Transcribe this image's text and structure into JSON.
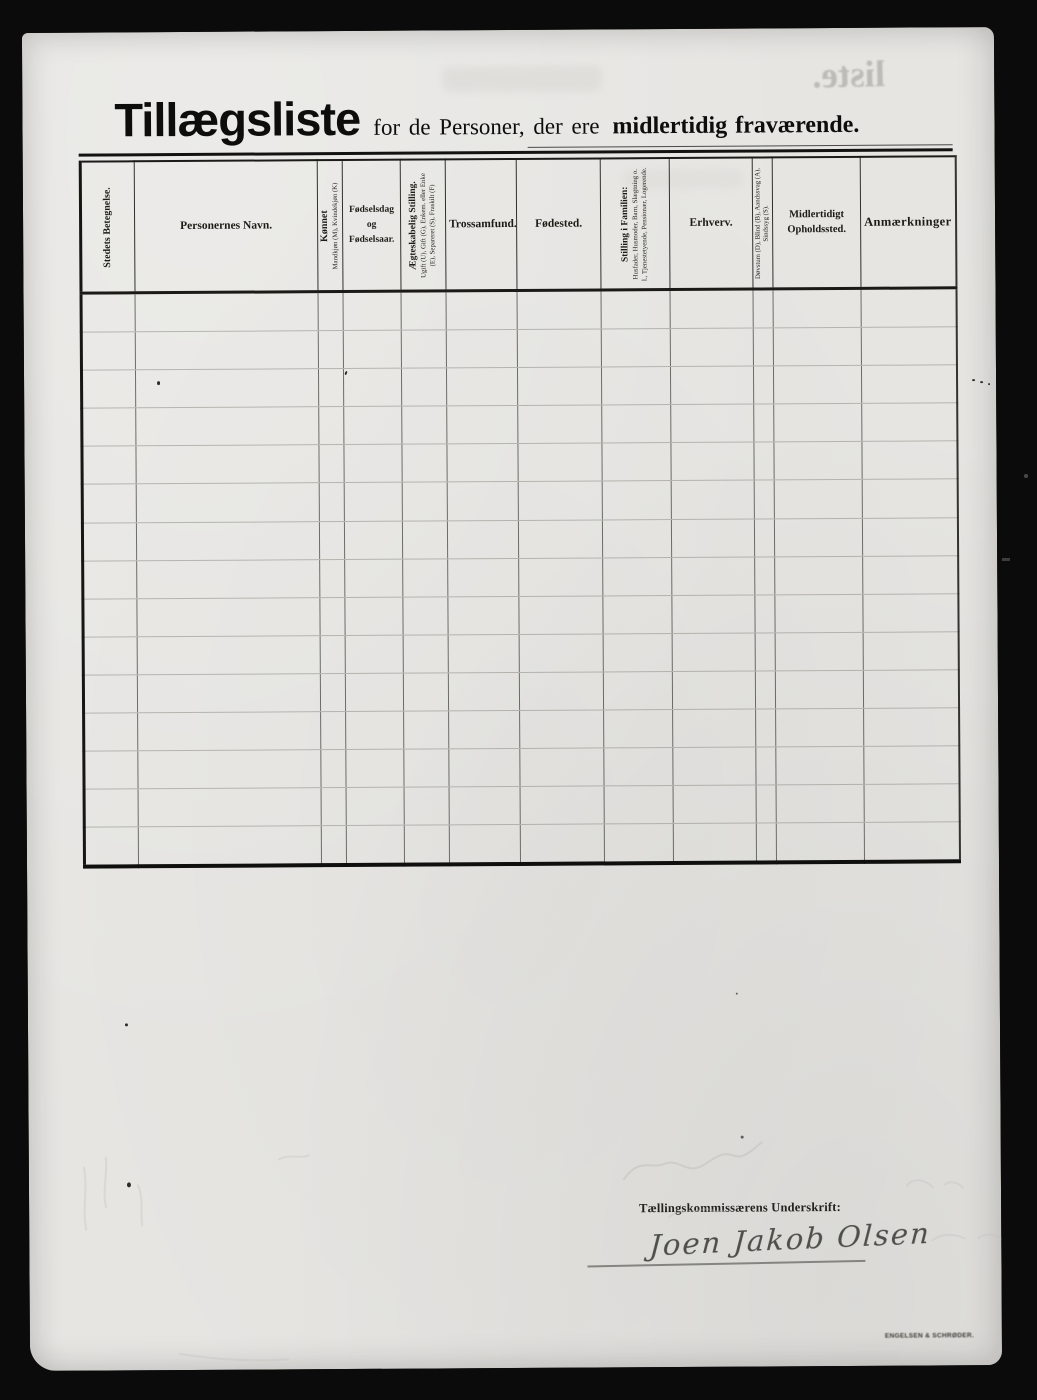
{
  "document": {
    "title": {
      "main": "Tillægsliste",
      "mid": "for de Personer, der ere",
      "emphasis": "midlertidig fraværende."
    }
  },
  "table": {
    "row_count": 15,
    "columns": [
      {
        "label": "Stedets Betegnelse."
      },
      {
        "label": "Personernes Navn."
      },
      {
        "label": "Kønnet",
        "sublabel": "Mandkjøn (M), Kvindekjøn (K)"
      },
      {
        "label": "Fødselsdag og Fødselsaar."
      },
      {
        "label": "Ægteskabelig Stilling.",
        "sublabel": "Ugift (U), Gift (G), Enkem. eller Enke (E), Separeret (S), Fraskilt (F)"
      },
      {
        "label": "Trossamfund."
      },
      {
        "label": "Fødested."
      },
      {
        "label": "Stilling i Familien:",
        "sublabel": "Husfader, Husmoder, Barn, Slægtning o. l., Tjenestetyende, Pensionær, Logerende."
      },
      {
        "label": "Erhverv."
      },
      {
        "label": "Døvstum (D), Blind (B), Aandssvag (A), Sindssyg (S)."
      },
      {
        "label": "Midlertidigt Opholdssted."
      },
      {
        "label": "Anmærkninger"
      }
    ]
  },
  "signature": {
    "label": "Tællingskommissærens Underskrift:",
    "name": "Joen Jakob Olsen"
  },
  "footer": {
    "printer_mark": "ENGELSEN & SCHRØDER."
  },
  "artifacts": {
    "bleedthrough_title": "liste."
  }
}
